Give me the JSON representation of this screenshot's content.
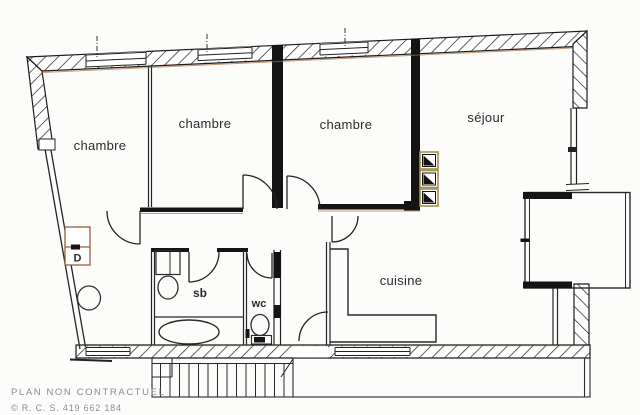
{
  "document": {
    "type": "apartment floor plan scan",
    "footer": {
      "line1": "PLAN NON CONTRACTUEL",
      "line2": "© R. C. S. 419 662 184"
    }
  },
  "rooms": {
    "bedroom1": {
      "label": "chambre"
    },
    "bedroom2": {
      "label": "chambre"
    },
    "bedroom3": {
      "label": "chambre"
    },
    "living": {
      "label": "séjour"
    },
    "kitchen": {
      "label": "cuisine"
    },
    "bathroom": {
      "label": "sb"
    },
    "toilet": {
      "label": "wc"
    },
    "closet": {
      "label": "D"
    }
  },
  "colors": {
    "paper": "#fcfcfa",
    "ink": "#1c1c1c",
    "wall_fill": "#141414",
    "scan_warm_accent": "#b06a3c",
    "closet_outline": "#9a5c40",
    "vent_border": "#a28f4d",
    "footer_gray": "#868d95"
  }
}
